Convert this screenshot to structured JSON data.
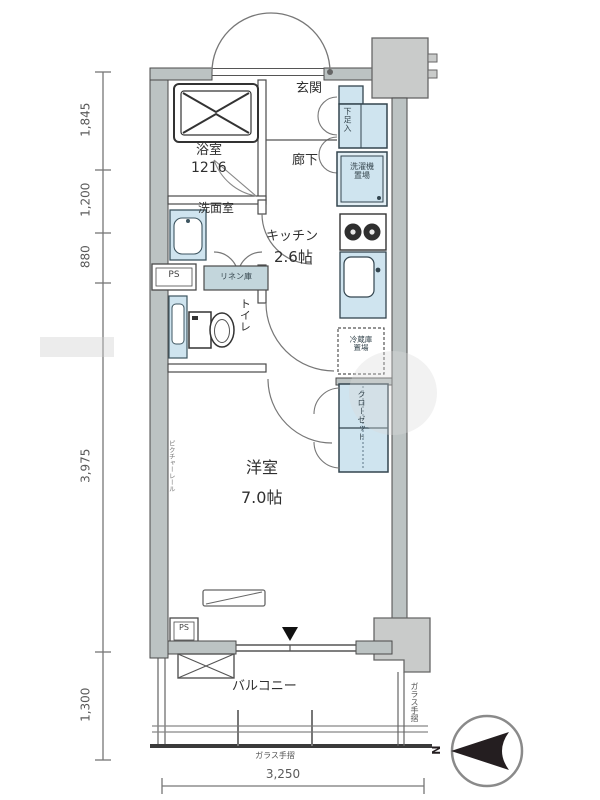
{
  "rooms": {
    "entrance": "玄関",
    "hallway": "廊下",
    "bathroom": "浴室",
    "bathroom_size": "1216",
    "washroom": "洗面室",
    "kitchen": "キッチン",
    "kitchen_size": "2.6帖",
    "toilet": "トイレ",
    "main_room": "洋室",
    "main_room_size": "7.0帖",
    "balcony": "バルコニー"
  },
  "fixtures": {
    "shoe_cabinet": "下足入",
    "washer_space": "洗濯機\n置場",
    "fridge_space": "冷蔵庫\n置場",
    "closet": "クローゼット",
    "linen_cabinet": "リネン庫",
    "pipe_space_upper": "PS",
    "pipe_space_lower": "PS",
    "picture_rail": "ピクチャーレール",
    "glass_rail_bottom": "ガラス手摺",
    "glass_rail_right": "ガラス手摺"
  },
  "dimensions": {
    "left_mm": [
      "1,845",
      "1,200",
      "880",
      "3,975",
      "1,300"
    ],
    "bottom_mm": "3,250"
  },
  "compass": {
    "north_label": "N"
  },
  "colors": {
    "fixture_blue": "#cfe4ef",
    "wall_gray": "#bcc3c3",
    "pillar_gray": "#c9cbca",
    "line_dark": "#4a4a4a"
  }
}
